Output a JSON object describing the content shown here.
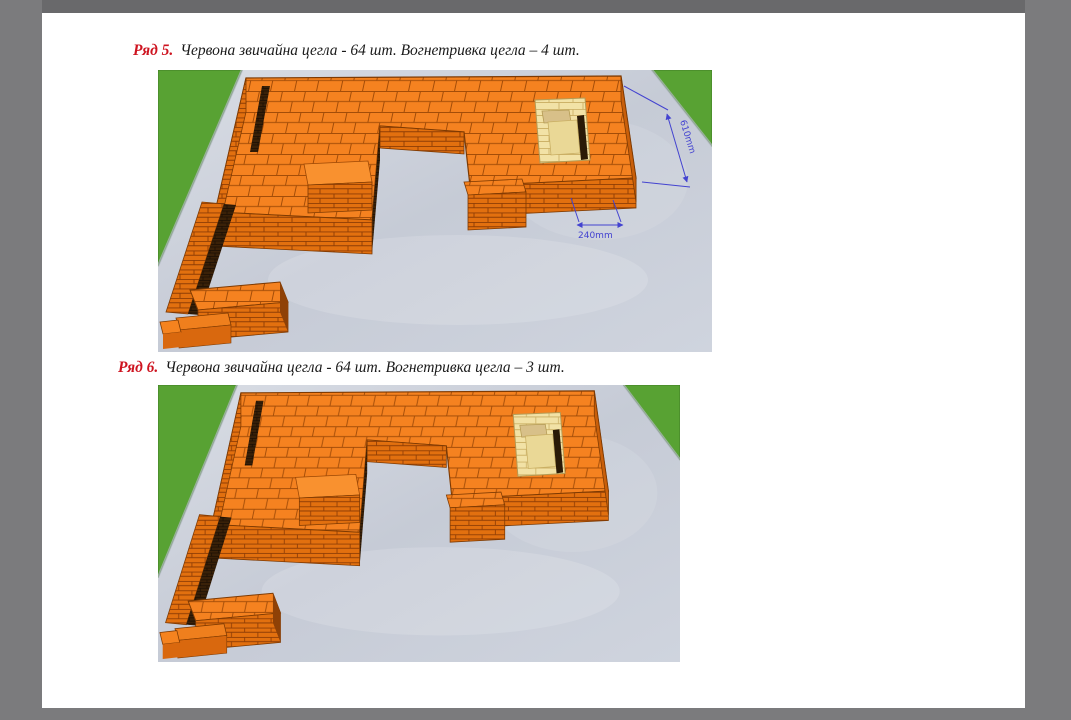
{
  "window": {
    "background_color": "#7b7b7d",
    "top_edge_color": "#69696b",
    "page_color": "#ffffff"
  },
  "document": {
    "rows": [
      {
        "label": "Ряд 5.",
        "description": "Червона звичайна цегла - 64 шт. Вогнетривка цегла – 4 шт."
      },
      {
        "label": "Ряд 6.",
        "description": "Червона звичайна цегла - 64 шт. Вогнетривка цегла – 3 шт."
      }
    ],
    "figure_dimensions": {
      "height_label": "610mm",
      "width_label": "240mm"
    },
    "colors": {
      "heading_label_red": "#ce1420",
      "body_text": "#1a1a1a",
      "brick_top": "#f58220",
      "brick_front": "#e2700f",
      "brick_side": "#c95f0a",
      "brick_dark_face": "#3a2108",
      "firebrick": "#f2e2a6",
      "firebrick_inner": "#ead896",
      "grass": "#58a233",
      "concrete": "#ccd1db",
      "dimension_lines": "#4343d0"
    }
  }
}
